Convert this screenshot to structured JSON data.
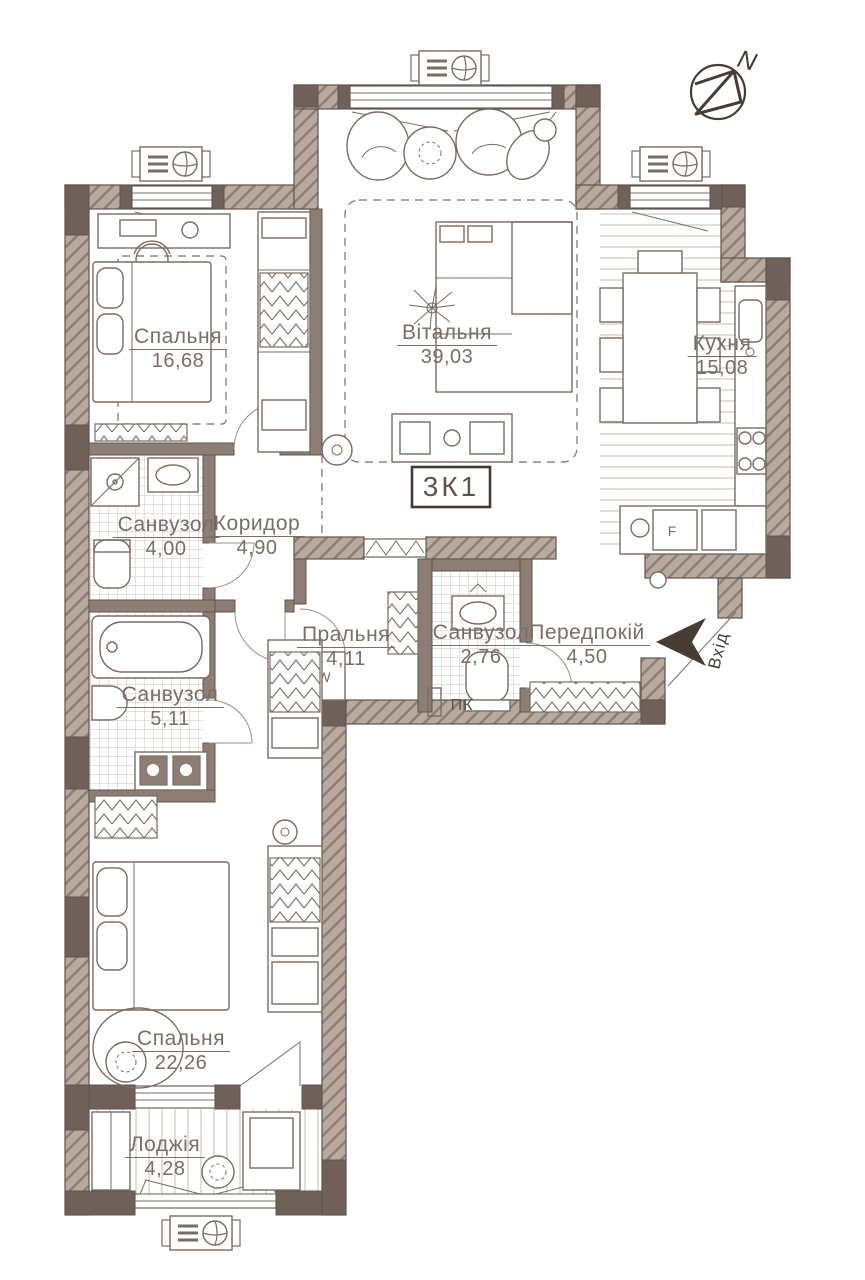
{
  "plan": {
    "unit_label": "3К1",
    "north_label": "N",
    "entrance_label": "Вхід",
    "fire_cabinet_label": "ПК",
    "washer_label": "W",
    "fridge_label": "F"
  },
  "rooms": [
    {
      "id": "bedroom-1",
      "name": "Спальня",
      "area": "16,68"
    },
    {
      "id": "living-room",
      "name": "Вітальня",
      "area": "39,03"
    },
    {
      "id": "kitchen",
      "name": "Кухня",
      "area": "15,08"
    },
    {
      "id": "bathroom-1",
      "name": "Санвузол",
      "area": "4,00"
    },
    {
      "id": "corridor",
      "name": "Коридор",
      "area": "4,90"
    },
    {
      "id": "laundry",
      "name": "Пральня",
      "area": "4,11"
    },
    {
      "id": "bathroom-2",
      "name": "Санвузол",
      "area": "2,76"
    },
    {
      "id": "entry-hall",
      "name": "Передпокій",
      "area": "4,50"
    },
    {
      "id": "bathroom-3",
      "name": "Санвузол",
      "area": "5,11"
    },
    {
      "id": "bedroom-2",
      "name": "Спальня",
      "area": "22,26"
    },
    {
      "id": "loggia",
      "name": "Лоджія",
      "area": "4,28"
    }
  ],
  "colors": {
    "wall": "#8d7e75",
    "wallDark": "#6f6159",
    "wallLight": "#b9aa9f",
    "line": "#5f544c",
    "furn": "#7a6d64",
    "label": "#7b6e66",
    "accent": "#463c35",
    "tile": "#cdc5be",
    "stripe": "#cfc7bf",
    "paper": "#ffffff"
  }
}
